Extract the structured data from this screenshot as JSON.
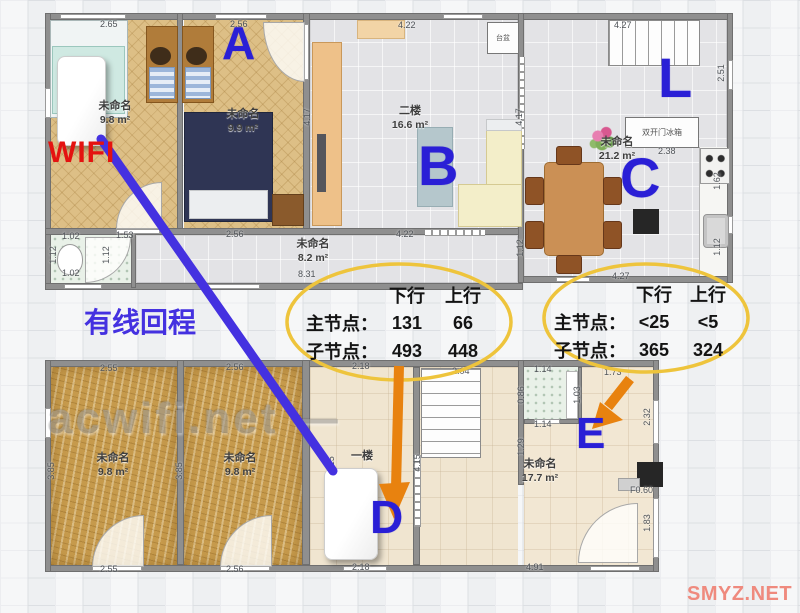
{
  "watermarks": {
    "center": "acwifi.net —",
    "corner": "SMYZ.NET"
  },
  "colors": {
    "letter": "#2a1fd6",
    "wifi_text": "#e41210",
    "backhaul": "#4431e0",
    "arrow": "#e8820f",
    "oval": "#eec43c",
    "table_text": "#141414",
    "watermark_center": "#9a9a9a",
    "watermark_corner": "#ef8a7e"
  },
  "annotations": {
    "wifi": "WIFI",
    "backhaul": "有线回程",
    "letters": [
      {
        "t": "A",
        "x": 222,
        "y": 20,
        "s": 46
      },
      {
        "t": "B",
        "x": 418,
        "y": 138,
        "s": 56
      },
      {
        "t": "C",
        "x": 620,
        "y": 150,
        "s": 56
      },
      {
        "t": "L",
        "x": 658,
        "y": 50,
        "s": 56
      },
      {
        "t": "D",
        "x": 370,
        "y": 494,
        "s": 46
      },
      {
        "t": "E",
        "x": 576,
        "y": 412,
        "s": 44
      }
    ]
  },
  "tables": [
    {
      "h1": "下行",
      "h2": "上行",
      "rows": [
        {
          "l": "主节点：",
          "d": "131",
          "u": "66"
        },
        {
          "l": "子节点：",
          "d": "493",
          "u": "448"
        }
      ]
    },
    {
      "h1": "下行",
      "h2": "上行",
      "rows": [
        {
          "l": "主节点：",
          "d": "<25",
          "u": "<5"
        },
        {
          "l": "子节点：",
          "d": "365",
          "u": "324"
        }
      ]
    }
  ],
  "floor2": {
    "rooms": [
      {
        "name": "未命名",
        "area": "9.8 m²",
        "x": 80,
        "y": 100,
        "w": 70
      },
      {
        "name": "未命名",
        "area": "9.9 m²",
        "x": 208,
        "y": 108,
        "w": 70
      },
      {
        "name": "二楼",
        "area": "16.6 m²",
        "x": 375,
        "y": 105,
        "w": 70
      },
      {
        "name": "未命名",
        "area": "21.2 m²",
        "x": 582,
        "y": 136,
        "w": 70
      },
      {
        "name": "未命名",
        "area": "8.2 m²",
        "x": 278,
        "y": 238,
        "w": 70
      }
    ],
    "labels": {
      "fridge": "双开门冰箱",
      "basin": "台盆"
    },
    "measurements": [
      {
        "t": "2.65",
        "x": 100,
        "y": 19
      },
      {
        "t": "2.56",
        "x": 230,
        "y": 19
      },
      {
        "t": "4.22",
        "x": 398,
        "y": 20
      },
      {
        "t": "4.27",
        "x": 614,
        "y": 20
      },
      {
        "t": "4.17",
        "x": 298,
        "y": 112,
        "v": 1
      },
      {
        "t": "4.17",
        "x": 510,
        "y": 112,
        "v": 1
      },
      {
        "t": "2.51",
        "x": 712,
        "y": 68,
        "v": 1
      },
      {
        "t": "2.38",
        "x": 658,
        "y": 146
      },
      {
        "t": "1.62",
        "x": 708,
        "y": 176,
        "v": 1
      },
      {
        "t": "1.12",
        "x": 708,
        "y": 242,
        "v": 1
      },
      {
        "t": "1.12",
        "x": 511,
        "y": 243,
        "v": 1
      },
      {
        "t": "4.27",
        "x": 612,
        "y": 271
      },
      {
        "t": "1.02",
        "x": 62,
        "y": 231
      },
      {
        "t": "1.53",
        "x": 116,
        "y": 230
      },
      {
        "t": "2.56",
        "x": 226,
        "y": 229
      },
      {
        "t": "1.12",
        "x": 44,
        "y": 250,
        "v": 1
      },
      {
        "t": "1.12",
        "x": 97,
        "y": 250,
        "v": 1
      },
      {
        "t": "1.02",
        "x": 62,
        "y": 268
      },
      {
        "t": "8.31",
        "x": 298,
        "y": 269
      },
      {
        "t": "4.22",
        "x": 396,
        "y": 229
      }
    ]
  },
  "floor1": {
    "rooms": [
      {
        "name": "未命名",
        "area": "9.8 m²",
        "x": 78,
        "y": 452,
        "w": 70
      },
      {
        "name": "未命名",
        "area": "9.8 m²",
        "x": 205,
        "y": 452,
        "w": 70
      },
      {
        "name": "一楼",
        "area": "",
        "x": 332,
        "y": 450,
        "w": 60
      },
      {
        "name": "未命名",
        "area": "17.7 m²",
        "x": 505,
        "y": 458,
        "w": 70
      }
    ],
    "measurements": [
      {
        "t": "2.55",
        "x": 100,
        "y": 363
      },
      {
        "t": "2.56",
        "x": 226,
        "y": 362
      },
      {
        "t": "2.18",
        "x": 352,
        "y": 361
      },
      {
        "t": "2.04",
        "x": 452,
        "y": 366
      },
      {
        "t": "1.14",
        "x": 534,
        "y": 364
      },
      {
        "t": "1.73",
        "x": 604,
        "y": 367
      },
      {
        "t": "1.03",
        "x": 568,
        "y": 390,
        "v": 1
      },
      {
        "t": "0.86",
        "x": 512,
        "y": 390,
        "v": 1
      },
      {
        "t": "1.14",
        "x": 534,
        "y": 419
      },
      {
        "t": "1.29",
        "x": 512,
        "y": 442,
        "v": 1
      },
      {
        "t": "4.15",
        "x": 322,
        "y": 460,
        "v": 1
      },
      {
        "t": "4.15",
        "x": 408,
        "y": 458,
        "v": 1
      },
      {
        "t": "2.32",
        "x": 638,
        "y": 412,
        "v": 1
      },
      {
        "t": "1.83",
        "x": 638,
        "y": 518,
        "v": 1
      },
      {
        "t": "3.85",
        "x": 42,
        "y": 466,
        "v": 1
      },
      {
        "t": "3.85",
        "x": 170,
        "y": 466,
        "v": 1
      },
      {
        "t": "F0.60",
        "x": 630,
        "y": 485
      },
      {
        "t": "2.55",
        "x": 100,
        "y": 564
      },
      {
        "t": "2.56",
        "x": 226,
        "y": 564
      },
      {
        "t": "2.18",
        "x": 352,
        "y": 562
      },
      {
        "t": "4.91",
        "x": 526,
        "y": 562
      }
    ]
  }
}
